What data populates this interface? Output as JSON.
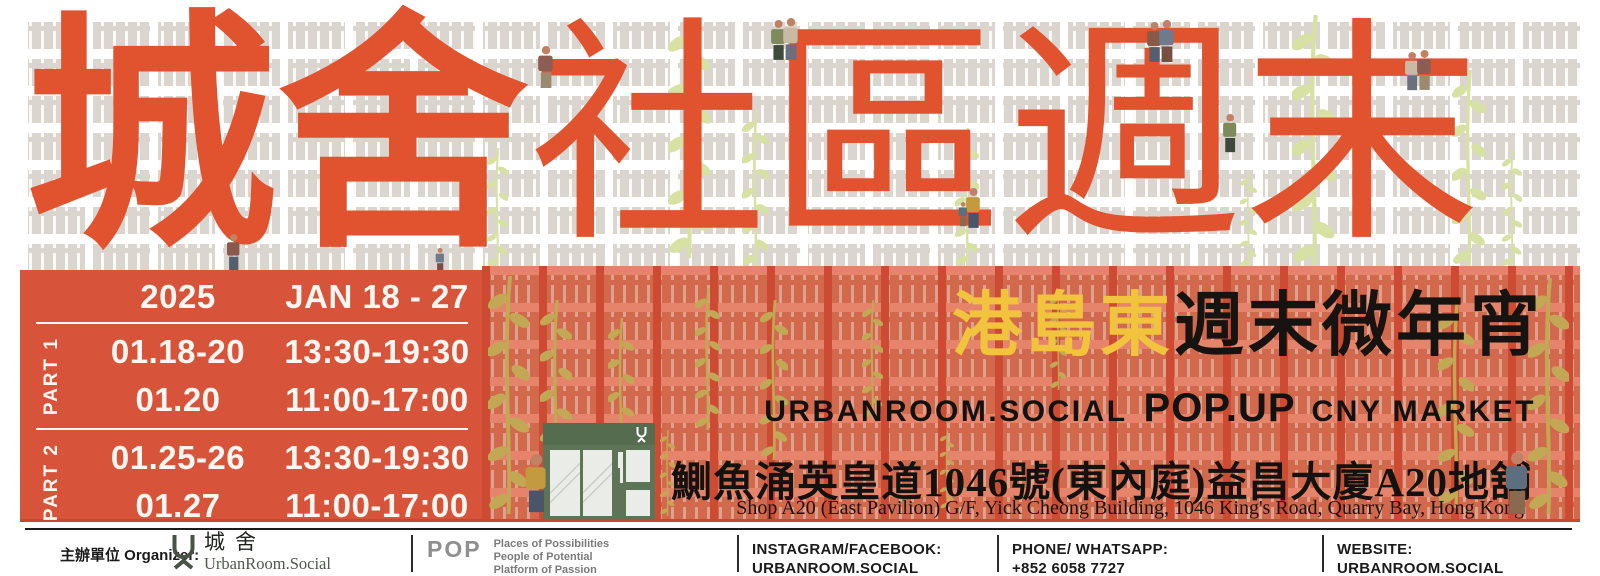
{
  "colors": {
    "accent_orange": "#E1522F",
    "panel_orange": "#D7533A",
    "salmon_block": "#E5846B",
    "highlight_yellow": "#F2C43D",
    "storefront_green": "#5D7456",
    "leaf_light": "#D7E1A4",
    "leaf_olive": "#C2A855"
  },
  "title": {
    "chars": [
      "城",
      "舍",
      "社",
      "區",
      "週",
      "末"
    ]
  },
  "schedule": {
    "year": "2025",
    "date_range": "JAN 18 - 27",
    "parts": [
      {
        "label": "PART 1",
        "rows": [
          {
            "dates": "01.18-20",
            "times": "13:30-19:30"
          },
          {
            "dates": "01.20",
            "times": "11:00-17:00"
          }
        ]
      },
      {
        "label": "PART 2",
        "rows": [
          {
            "dates": "01.25-26",
            "times": "13:30-19:30"
          },
          {
            "dates": "01.27",
            "times": "11:00-17:00"
          }
        ]
      }
    ]
  },
  "event": {
    "headline_highlight": "港島東",
    "headline_rest": "週末微年宵",
    "market_left": "URBANROOM.SOCIAL",
    "market_bold": "POP.UP",
    "market_right": "CNY MARKET",
    "address_zh": "鰂魚涌英皇道1046號(東內庭)益昌大廈A20地舖",
    "address_en": "Shop A20 (East Pavilion) G/F, Yick Cheong Building, 1046 King's Road, Quarry Bay, Hong Kong"
  },
  "footer": {
    "organizer_label": "主辦單位 Organizer:",
    "organizer_zh": "城舍",
    "organizer_en": "UrbanRoom.Social",
    "pop_logo": "POP",
    "pop_lines": [
      "Places of Possibilities",
      "People of Potential",
      "Platform of Passion"
    ],
    "instagram_label": "INSTAGRAM/FACEBOOK:",
    "instagram_value": "URBANROOM.SOCIAL",
    "phone_label": "PHONE/ WHATSAPP:",
    "phone_value": "+852 6058 7727",
    "website_label": "WEBSITE:",
    "website_value": "URBANROOM.SOCIAL"
  }
}
